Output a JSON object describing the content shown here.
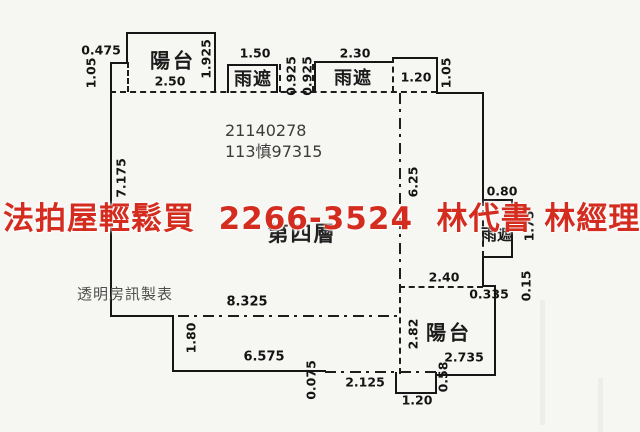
{
  "watermark": {
    "text": "法拍屋輕鬆買  2266-3524  林代書 林經理",
    "color": "#d42d20"
  },
  "stamp": {
    "line1": "21140278",
    "line2": "113慎97315"
  },
  "floor_label": "第四層",
  "maker_label": "透明房訊製表",
  "rooms": {
    "balcony_top": "陽台",
    "canopy_top_left": "雨遮",
    "canopy_top_right": "雨遮",
    "canopy_right": "雨遮",
    "balcony_bottom": "陽台"
  },
  "dims": {
    "top_left_width": "0.475",
    "top_left_height": "1.05",
    "balcony_top_width": "2.50",
    "balcony_top_height": "1.925",
    "canopy1_width": "1.50",
    "gap_a": "0.925",
    "gap_b": "0.925",
    "canopy2_width": "2.30",
    "top_box_width": "1.20",
    "top_right_height": "1.05",
    "left_wall_height": "7.175",
    "right_inner_height": "6.25",
    "canopy_right_width": "0.80",
    "canopy_right_height": "1.75",
    "balcony2_top_width": "2.40",
    "step_width": "0.335",
    "step_height": "0.15",
    "inner_width": "8.325",
    "left_step_height": "1.80",
    "bottom_wall_length": "6.575",
    "balcony2_left_height": "2.82",
    "balcony2_right_height": "2.735",
    "tiny_step": "0.075",
    "bottom_gap": "2.125",
    "bottom_box_width": "1.20",
    "bottom_box_height": "0.58"
  }
}
